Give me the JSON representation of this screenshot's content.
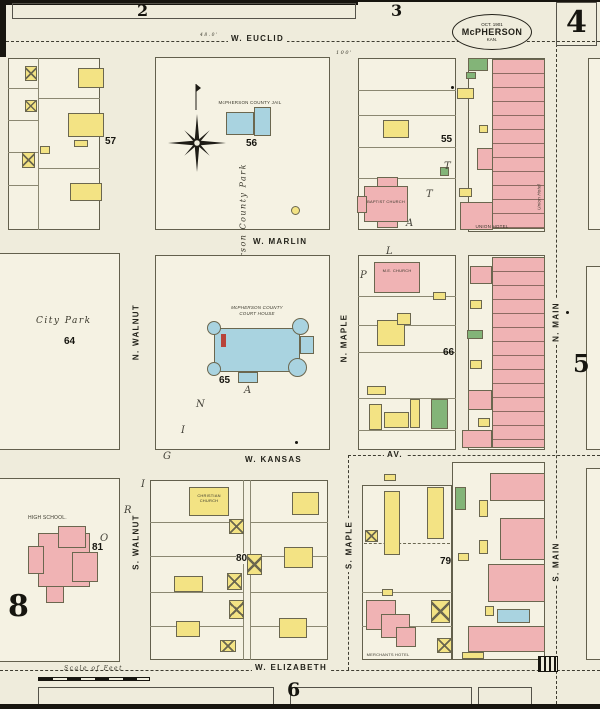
{
  "colors": {
    "paper": "#efecdc",
    "block_fill": "#f5f2e3",
    "dwelling_yellow": "#f3e384",
    "brick_pink": "#f0b3b4",
    "stone_blue": "#a9d3e0",
    "special_green": "#83b478",
    "ink": "#23221a"
  },
  "stamp": {
    "date": "OCT. 1901",
    "city": "McPHERSON",
    "state": "KAN."
  },
  "sheet": {
    "tab_2": "2",
    "tab_3": "3",
    "num_4": "4",
    "num_5": "5",
    "num_6": "6",
    "num_8": "8"
  },
  "streets": {
    "w_euclid": "W. EUCLID",
    "w_marlin": "W. MARLIN",
    "w_kansas": "W. KANSAS",
    "av": "AV.",
    "w_elizabeth": "W. ELIZABETH",
    "n_walnut": "N. WALNUT",
    "s_walnut": "S. WALNUT",
    "n_maple": "N. MAPLE",
    "s_maple": "S. MAPLE",
    "n_main": "N. MAIN",
    "s_main": "S. MAIN"
  },
  "blocks": {
    "b55": "55",
    "b56": "56",
    "b57": "57",
    "b64": "64",
    "b65": "65",
    "b66": "66",
    "b79": "79",
    "b80": "80",
    "b81": "81"
  },
  "labels": {
    "county_jail": "McPHERSON COUNTY JAIL",
    "court_house_line1": "McPHERSON COUNTY",
    "court_house_line2": "COURT HOUSE",
    "city_park": "City Park",
    "county_park": "Mc Pherson County Park",
    "baptist_church": "BAPTIST CHURCH",
    "me_church": "M.E. CHURCH",
    "christian_line1": "CHRISTIAN",
    "christian_line2": "CHURCH",
    "high_school": "HIGH SCHOOL.",
    "union_hotel": "UNION HOTEL",
    "union_hotel_side": "Union Hotel",
    "merchants_hotel": "MERCHANTS HOTEL",
    "scale_of_feet": "Scale of Feet"
  },
  "dims": {
    "d1": "100'",
    "d2": "48.0'"
  },
  "scatter": [
    {
      "ch": "P"
    },
    {
      "ch": "L"
    },
    {
      "ch": "A"
    },
    {
      "ch": "T"
    },
    {
      "ch": "T"
    },
    {
      "ch": "O"
    },
    {
      "ch": "R"
    },
    {
      "ch": "I"
    },
    {
      "ch": "G"
    },
    {
      "ch": "I"
    },
    {
      "ch": "N"
    },
    {
      "ch": "A"
    }
  ]
}
